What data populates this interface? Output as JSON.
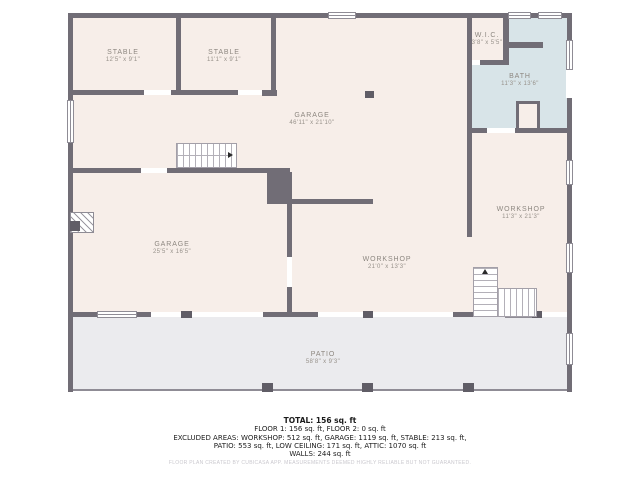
{
  "rooms": {
    "stable1": {
      "name": "STABLE",
      "dims": "12'5\" x 9'1\""
    },
    "stable2": {
      "name": "STABLE",
      "dims": "11'1\" x 9'1\""
    },
    "garage_top": {
      "name": "GARAGE",
      "dims": "46'11\" x 21'10\""
    },
    "wic": {
      "name": "W.I.C.",
      "dims": "3'8\" x 5'5\""
    },
    "bath": {
      "name": "BATH",
      "dims": "11'3\" x 13'6\""
    },
    "workshop_right": {
      "name": "WORKSHOP",
      "dims": "11'3\" x 21'3\""
    },
    "garage_left": {
      "name": "GARAGE",
      "dims": "25'5\" x 16'5\""
    },
    "workshop_center": {
      "name": "WORKSHOP",
      "dims": "21'0\" x 13'3\""
    },
    "patio": {
      "name": "PATIO",
      "dims": "58'8\" x 9'3\""
    }
  },
  "summary": {
    "total": "TOTAL: 156 sq. ft",
    "floors": "FLOOR 1: 156 sq. ft, FLOOR 2: 0 sq. ft",
    "excluded1": "EXCLUDED AREAS: WORKSHOP: 512 sq. ft, GARAGE: 1119 sq. ft, STABLE: 213 sq. ft,",
    "excluded2": "PATIO: 553 sq. ft, LOW CEILING: 171 sq. ft, ATTIC: 1070 sq. ft",
    "walls": "WALLS: 244 sq. ft",
    "disclaimer": "FLOOR PLAN CREATED BY CUBICASA APP. MEASUREMENTS DEEMED HIGHLY RELIABLE BUT NOT GUARANTEED."
  },
  "colors": {
    "wall": "#716d76",
    "room_fill": "#f7eee9",
    "bath_fill": "#d8e4e8",
    "patio_fill": "#ebebee",
    "label_text": "#8d8780"
  }
}
